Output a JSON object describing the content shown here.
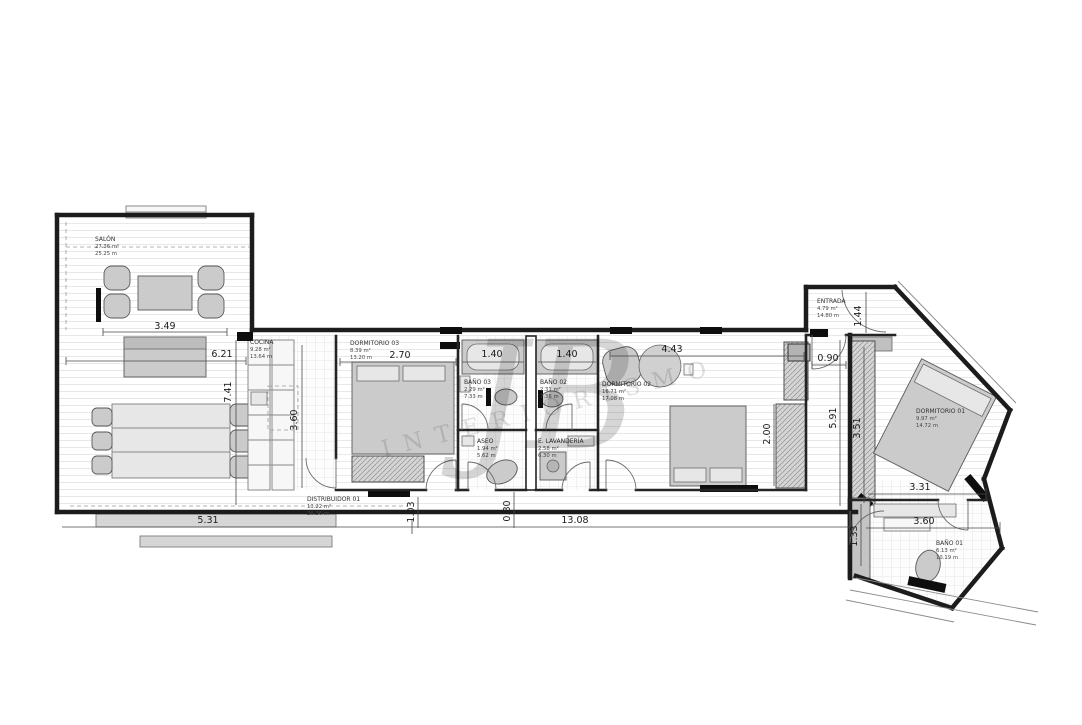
{
  "palette": {
    "wall": "#1c1c1c",
    "furniture": "#cbcbcb",
    "watermark_gray": "#9a9a9a",
    "floor_line": "#e8e8e8"
  },
  "watermark": {
    "initials": "JB",
    "word": "INTERIORISMO"
  },
  "rooms": {
    "salon": {
      "name": "SALÓN",
      "area": "27.36 m²",
      "perimeter": "25.25 m"
    },
    "cocina": {
      "name": "COCINA",
      "area": "9.28 m²",
      "perimeter": "13.64 m"
    },
    "dormitorio03": {
      "name": "DORMITORIO 03",
      "area": "8.39 m²",
      "perimeter": "13.20 m"
    },
    "bano03": {
      "name": "BAÑO 03",
      "area": "2.29 m²",
      "perimeter": "7.33 m"
    },
    "bano02": {
      "name": "BAÑO 02",
      "area": "2.31 m²",
      "perimeter": "7.36 m"
    },
    "aseo": {
      "name": "ASEO",
      "area": "1.94 m²",
      "perimeter": "5.62 m"
    },
    "lavanderia": {
      "name": "E. LAVANDERÍA",
      "area": "2.58 m²",
      "perimeter": "6.30 m"
    },
    "dormitorio02": {
      "name": "DORMITORIO 02",
      "area": "16.71 m²",
      "perimeter": "17.08 m"
    },
    "distribuidor": {
      "name": "DISTRIBUIDOR 01",
      "area": "13.22 m²",
      "perimeter": "26.36 m"
    },
    "entrada": {
      "name": "ENTRADA",
      "area": "4.79 m²",
      "perimeter": "14.80 m"
    },
    "dormitorio01": {
      "name": "DORMITORIO 01",
      "area": "9.97 m²",
      "perimeter": "14.72 m"
    },
    "bano01": {
      "name": "BAÑO 01",
      "area": "6.13 m²",
      "perimeter": "10.19 m"
    }
  },
  "dimensions": [
    "3.49",
    "6.21",
    "7.41",
    "3.60",
    "2.70",
    "1.40",
    "1.40",
    "4.43",
    "0.90",
    "1.44",
    "5.91",
    "3.51",
    "2.00",
    "5.31",
    "1.03",
    "0.80",
    "13.08",
    "3.31",
    "3.60",
    "1.33"
  ]
}
